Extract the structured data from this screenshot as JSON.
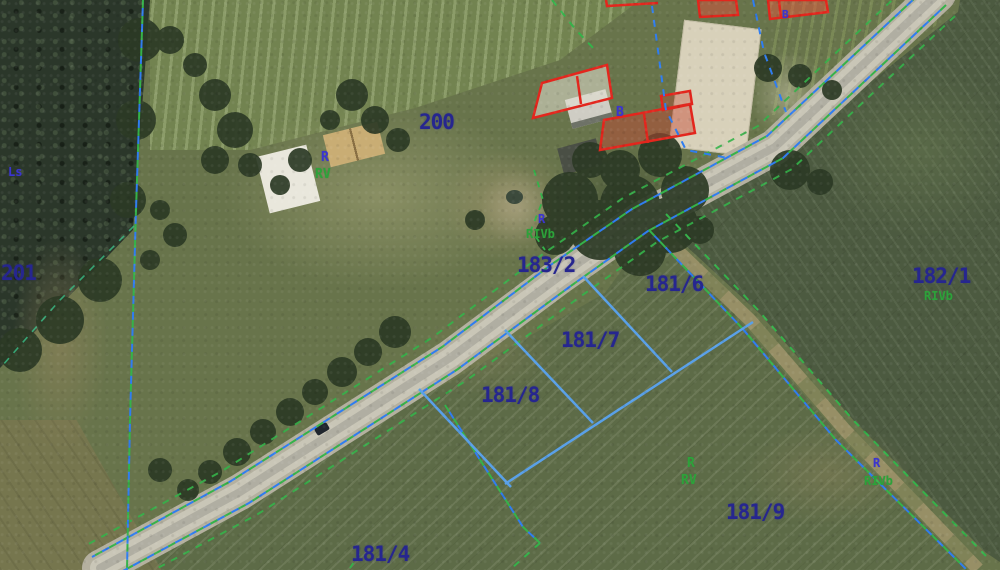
{
  "map": {
    "labels": {
      "p201": "201",
      "p200": "200",
      "p183_2": "183/2",
      "p181_6": "181/6",
      "p181_7": "181/7",
      "p181_8": "181/8",
      "p181_9": "181/9",
      "p181_4": "181/4",
      "p182_1": "182/1",
      "ls_forest": "Ls",
      "b_house": "B",
      "b_top": "B",
      "r_lawn": "R",
      "rv_lawn": "RV",
      "r_garden": "R",
      "rivb_garden": "RIVb",
      "rivb_182": "RIVb",
      "r_field9": "R",
      "rv_field9": "RV",
      "r_right": "R",
      "rivb_right": "RIVb"
    },
    "legend_semantics": {
      "parcel_number_color": "#26268f",
      "landuse_code_color": "#2da23a",
      "soil_class_color": "#3b35cf",
      "building_outline_color": "#e3261d",
      "parcel_boundary_blue": "#2f7df0",
      "parcel_boundary_green": "#35b24a",
      "subdivision_line_color": "#59a0e8"
    }
  }
}
